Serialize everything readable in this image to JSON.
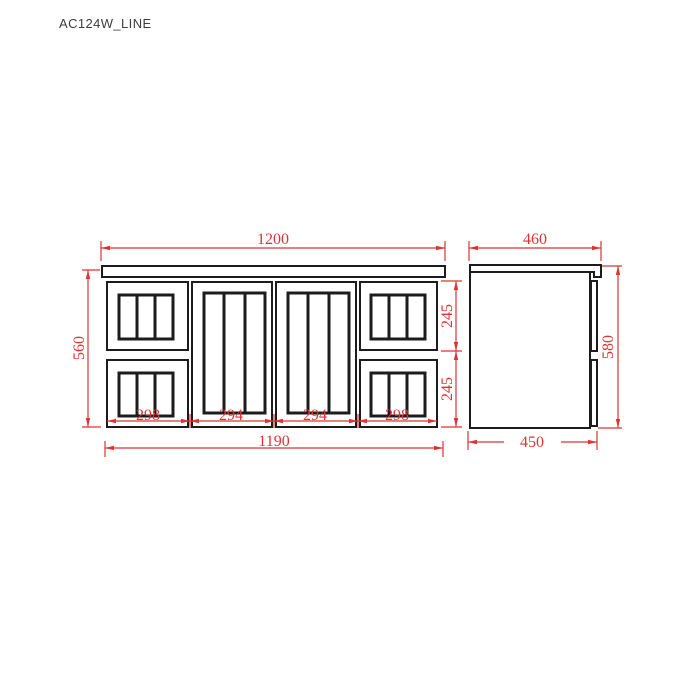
{
  "title": "AC124W_LINE",
  "colors": {
    "background": "#ffffff",
    "line": "#1c1c1c",
    "dimension": "#dd3333"
  },
  "front_view": {
    "top_width": "1200",
    "bottom_width": "1190",
    "left_height": "560",
    "right_heights": [
      "245",
      "245"
    ],
    "panel_widths": [
      "298",
      "294",
      "294",
      "298"
    ]
  },
  "side_view": {
    "top_depth": "460",
    "bottom_depth": "450",
    "right_height": "580"
  }
}
